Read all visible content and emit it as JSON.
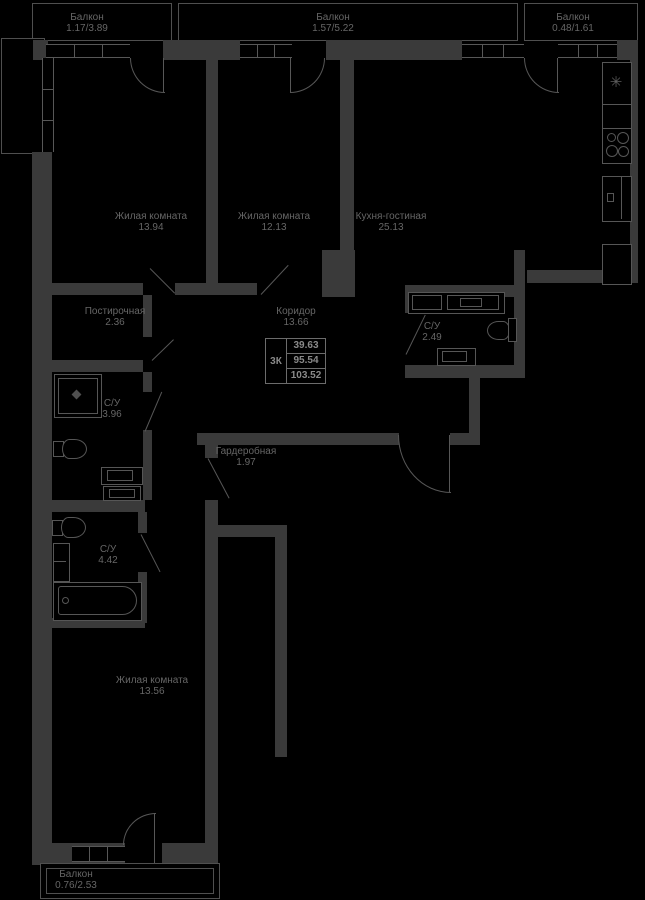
{
  "plan": {
    "stat": {
      "unit_type": "3К",
      "living_area": "39.63",
      "area": "95.54",
      "total_area": "103.52"
    },
    "rooms": [
      {
        "id": "living-room-1",
        "name": "Жилая комната",
        "area": "13.94"
      },
      {
        "id": "living-room-2",
        "name": "Жилая комната",
        "area": "12.13"
      },
      {
        "id": "kitchen-living",
        "name": "Кухня-гостиная",
        "area": "25.13"
      },
      {
        "id": "laundry",
        "name": "Постирочная",
        "area": "2.36"
      },
      {
        "id": "corridor",
        "name": "Коридор",
        "area": "13.66"
      },
      {
        "id": "bathroom-1",
        "name": "С/У",
        "area": "3.96"
      },
      {
        "id": "bathroom-2",
        "name": "С/У",
        "area": "2.49"
      },
      {
        "id": "bathroom-3",
        "name": "С/У",
        "area": "4.42"
      },
      {
        "id": "wardrobe",
        "name": "Гардеробная",
        "area": "1.97"
      },
      {
        "id": "living-room-3",
        "name": "Жилая комната",
        "area": "13.56"
      }
    ],
    "balconies": [
      {
        "id": "balcony-top-left",
        "name": "Балкон",
        "area": "1.17/3.89"
      },
      {
        "id": "balcony-top-middle",
        "name": "Балкон",
        "area": "1.57/5.22"
      },
      {
        "id": "balcony-top-right",
        "name": "Балкон",
        "area": "0.48/1.61"
      },
      {
        "id": "balcony-bottom",
        "name": "Балкон",
        "area": "0.76/2.53"
      }
    ],
    "icons": {
      "kitchen_sink": "✳"
    },
    "colors": {
      "background": "#000000",
      "wall": "#3a3a3a",
      "line": "#575757",
      "text": "#666666"
    }
  }
}
